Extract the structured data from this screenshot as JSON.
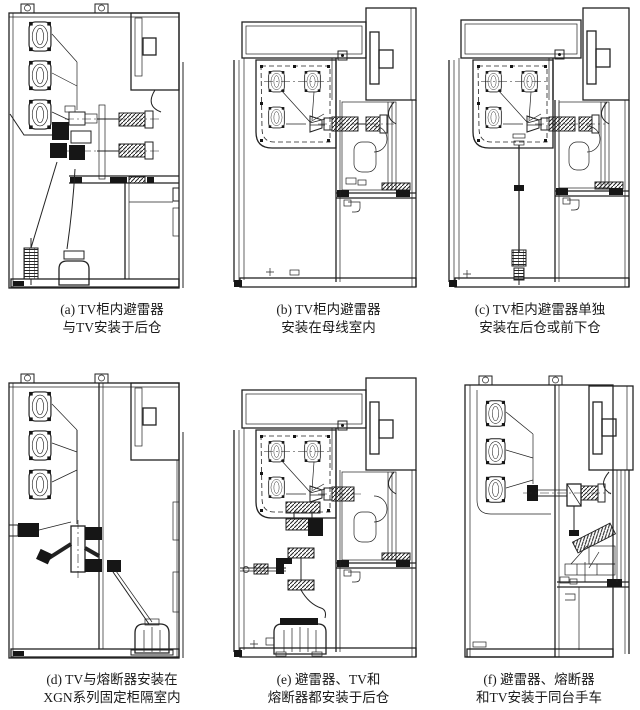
{
  "page": {
    "background": "#ffffff",
    "ink": "#222222",
    "description_type": "switchgear-cabinet-installation-diagrams"
  },
  "figures": [
    {
      "id": "a",
      "caption_line1": "(a) TV柜内避雷器",
      "caption_line2": "与TV安装于后仓"
    },
    {
      "id": "b",
      "caption_line1": "(b) TV柜内避雷器",
      "caption_line2": "安装在母线室内"
    },
    {
      "id": "c",
      "caption_line1": "(c) TV柜内避雷器单独",
      "caption_line2": "安装在后仓或前下仓"
    },
    {
      "id": "d",
      "caption_line1": "(d) TV与熔断器安装在",
      "caption_line2": "XGN系列固定柜隔室内"
    },
    {
      "id": "e",
      "caption_line1": "(e) 避雷器、TV和",
      "caption_line2": "熔断器都安装于后仓"
    },
    {
      "id": "f",
      "caption_line1": "(f) 避雷器、熔断器",
      "caption_line2": "和TV安装于同台手车"
    }
  ]
}
